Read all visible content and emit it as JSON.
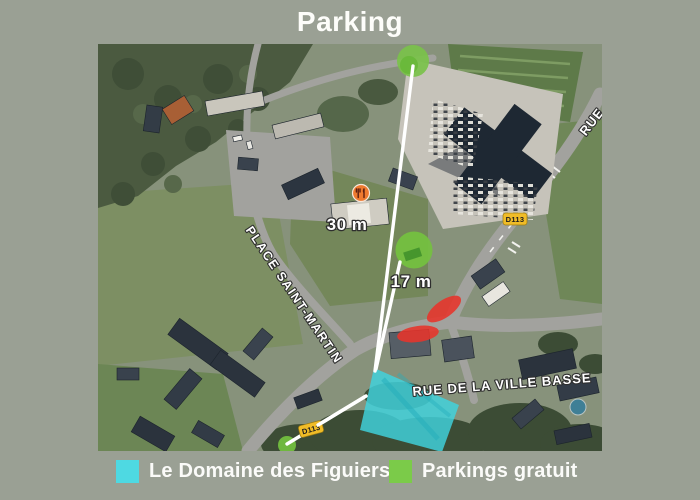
{
  "page": {
    "title": "Parking",
    "background_color": "#9aa094"
  },
  "legend": {
    "items": [
      {
        "label": "Le Domaine des Figuiers",
        "color": "#4ed9e2"
      },
      {
        "label": "Parkings gratuit",
        "color": "#7bcb49"
      }
    ]
  },
  "map": {
    "distance_labels": {
      "parking_top": "30 m",
      "parking_middle": "17 m"
    },
    "street_labels": {
      "place_saint_martin": "PLACE SAINT-MARTIN",
      "rue_de_la_ville_basse": "RUE DE LA VILLE BASSE",
      "rue_partial": "RUE"
    },
    "road_badges": {
      "d113_main": "D113",
      "d113_south": "D113"
    },
    "poi": {
      "restaurant": "restaurant"
    },
    "overlay_colors": {
      "domaine_highlight": "#3fd4df",
      "free_parking_marker": "#74c13f",
      "no_parking_zone": "#e8342b",
      "route_line": "#ffffff",
      "road_badge": "#f0bc27"
    }
  }
}
